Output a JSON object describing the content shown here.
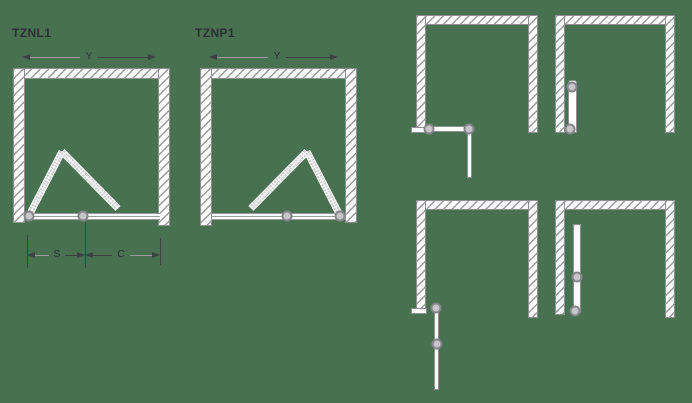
{
  "colors": {
    "background": "#47714F",
    "text": "#2e2e38",
    "dimension_line_dark": "#3f3f46",
    "dimension_line_light": "#9a9aa0",
    "wall_outline": "#8f8f95",
    "wall_fill": "#ffffff",
    "hinge_ring": "#85858b",
    "hinge_fill": "#c6c6ca",
    "glass_panel": "#cfcfd3"
  },
  "tznl1": {
    "title": "TZNL1",
    "labels": {
      "width": "Y",
      "s": "S",
      "c": "C"
    }
  },
  "tznp1": {
    "title": "TZNP1",
    "labels": {
      "width": "Y"
    }
  }
}
